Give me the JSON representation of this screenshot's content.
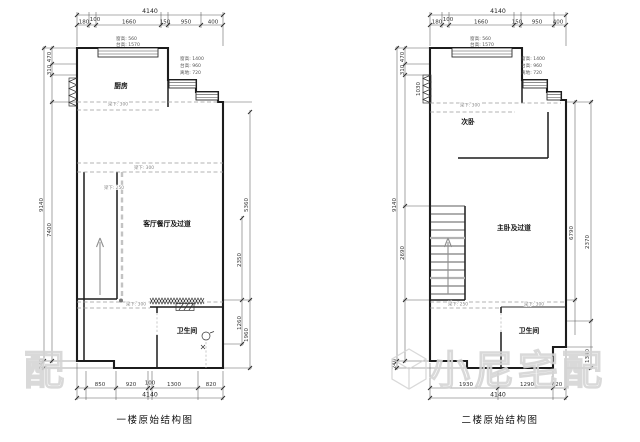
{
  "watermark": {
    "brand": "小尼宅配",
    "partial": "配"
  },
  "plan1": {
    "title": "一楼原始结构图",
    "rooms": {
      "kitchen": "厨房",
      "living": "客厅餐厅及过道",
      "bath": "卫生间"
    },
    "dims": {
      "top_total": "4140",
      "top_segments": [
        "180",
        "100",
        "1660",
        "150",
        "950",
        "400"
      ],
      "bottom_segments": [
        "850",
        "920",
        "100",
        "1300",
        "820"
      ],
      "bottom_total": "4140",
      "left": {
        "s470": "470",
        "s310": "310",
        "inner": "7400",
        "outer": "9140",
        "s240": "240"
      },
      "right": {
        "outer_upper": "5360",
        "inner_upper": "2350",
        "inner_lower": "1260",
        "outer_lower": "1960"
      }
    },
    "annotations": {
      "window_top": [
        "窗高: 560",
        "台高: 1570"
      ],
      "window_right": [
        "窗高: 1400",
        "台高: 960",
        "离地: 720"
      ],
      "beam_kitchen": "梁下: 300",
      "beam_mid_1": "梁下: 300",
      "beam_mid_2": "梁下: 250",
      "beam_low": "梁下: 300"
    }
  },
  "plan2": {
    "title": "二楼原始结构图",
    "rooms": {
      "bed": "次卧",
      "master": "主卧及过道",
      "bath": "卫生间"
    },
    "dims": {
      "top_total": "4140",
      "top_segments": [
        "180",
        "100",
        "1660",
        "150",
        "950",
        "400"
      ],
      "bottom_segments": [
        "1930",
        "1290",
        "820"
      ],
      "bottom_total": "4140",
      "left": {
        "s470": "470",
        "s310": "310",
        "stair": "2690",
        "outer": "9140",
        "s240": "240",
        "radiator": "1030"
      },
      "right": {
        "upper": "6790",
        "mid": "2370",
        "lower": "1340"
      }
    },
    "annotations": {
      "window_top": [
        "窗高: 560",
        "台高: 1570"
      ],
      "window_right": [
        "窗高: 1400",
        "台高: 960",
        "离地: 720"
      ],
      "beam_kitchen": "梁下: 300",
      "beam_low_1": "梁下: 250",
      "beam_low_2": "梁下: 300"
    }
  }
}
